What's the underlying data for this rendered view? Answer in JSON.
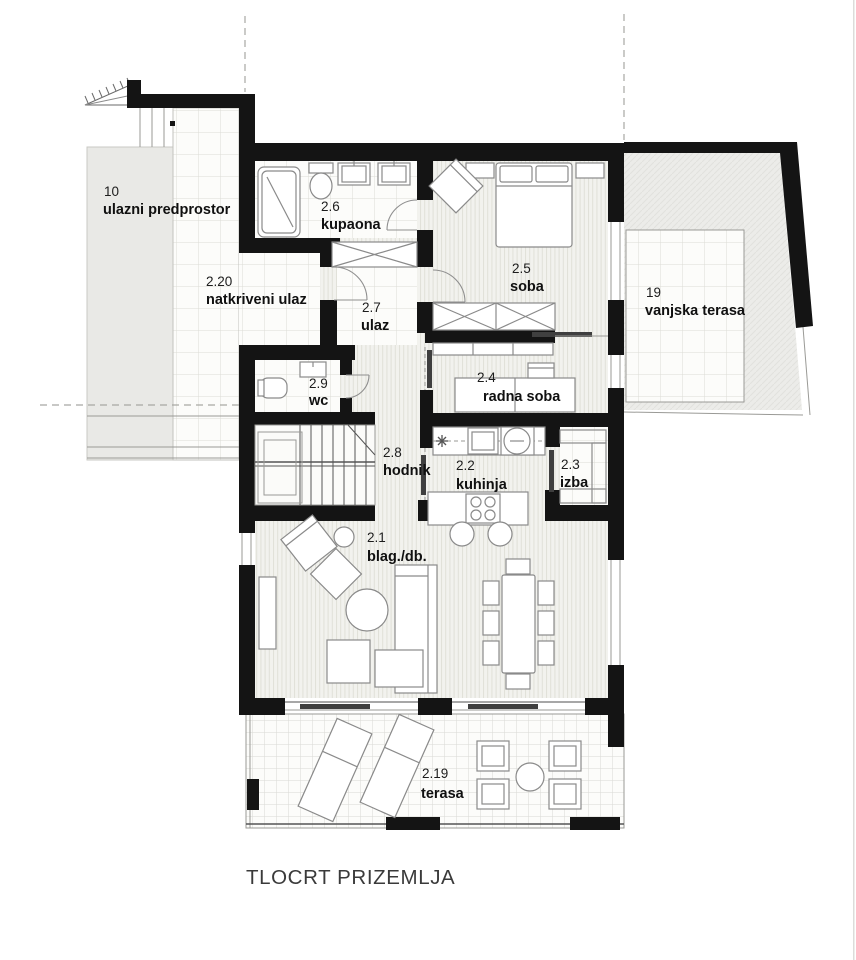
{
  "title": "TLOCRT PRIZEMLJA",
  "rooms": {
    "ulazni_predprostor": {
      "number": "10",
      "name": "ulazni predprostor"
    },
    "natkriveni_ulaz": {
      "number": "2.20",
      "name": "natkriveni ulaz"
    },
    "kupaona": {
      "number": "2.6",
      "name": "kupaona"
    },
    "ulaz": {
      "number": "2.7",
      "name": "ulaz"
    },
    "soba": {
      "number": "2.5",
      "name": "soba"
    },
    "vanjska_terasa": {
      "number": "19",
      "name": "vanjska terasa"
    },
    "wc": {
      "number": "2.9",
      "name": "wc"
    },
    "radna_soba": {
      "number": "2.4",
      "name": "radna soba"
    },
    "hodnik": {
      "number": "2.8",
      "name": "hodnik"
    },
    "kuhinja": {
      "number": "2.2",
      "name": "kuhinja"
    },
    "izba": {
      "number": "2.3",
      "name": "izba"
    },
    "blag_db": {
      "number": "2.1",
      "name": "blag./db."
    },
    "terasa": {
      "number": "2.19",
      "name": "terasa"
    }
  },
  "colors": {
    "wall": "#141414",
    "parquet_floor": "#f2f2ee",
    "tile_floor": "#fbfbf9",
    "exterior_gray": "#e9e9e6",
    "line_gray": "#8a8a8a",
    "text": "#1a1a1a"
  }
}
